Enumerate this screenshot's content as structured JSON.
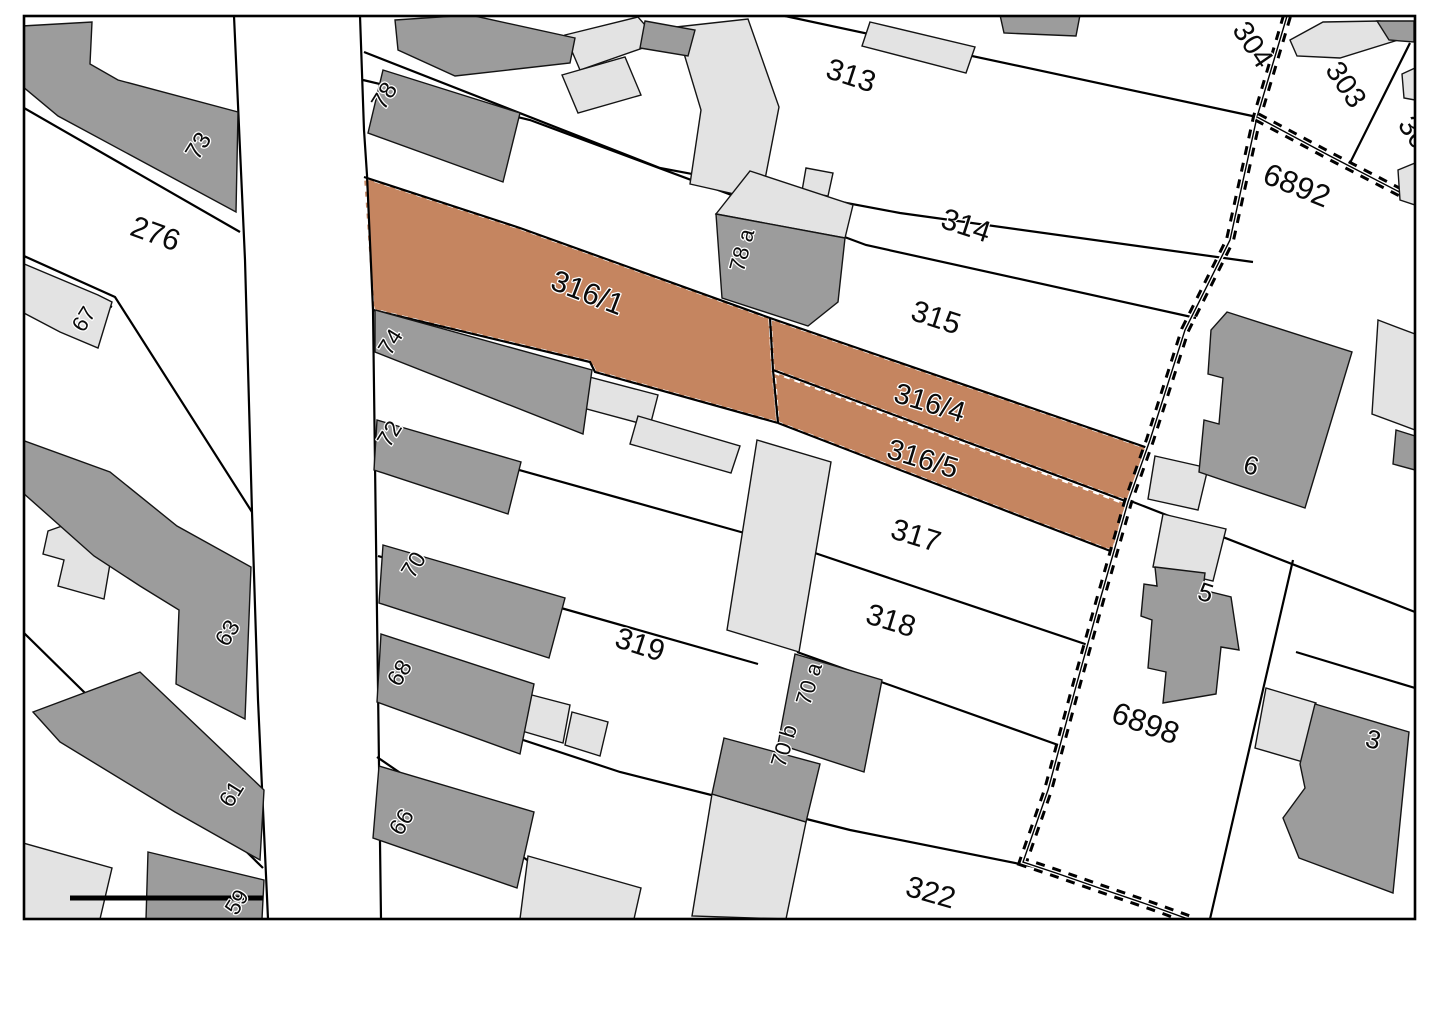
{
  "map": {
    "kind": "cadastral-parcel-map",
    "colors": {
      "highlight_parcel": "#c58560",
      "building_dark": "#9c9c9c",
      "building_light": "#e3e3e3",
      "line": "#000000",
      "background": "#ffffff"
    },
    "highlighted_parcels": [
      "316/1",
      "316/4",
      "316/5"
    ],
    "labels": [
      {
        "text": "73",
        "x": 205,
        "y": 150,
        "rot": -58,
        "size": 24,
        "kind": "building"
      },
      {
        "text": "78",
        "x": 391,
        "y": 100,
        "rot": -58,
        "size": 24,
        "kind": "building"
      },
      {
        "text": "276",
        "x": 152,
        "y": 243,
        "rot": 20,
        "size": 30,
        "kind": "parcel"
      },
      {
        "text": "67",
        "x": 90,
        "y": 323,
        "rot": -58,
        "size": 22,
        "kind": "building"
      },
      {
        "text": "313",
        "x": 848,
        "y": 85,
        "rot": 18,
        "size": 30,
        "kind": "parcel"
      },
      {
        "text": "314",
        "x": 963,
        "y": 235,
        "rot": 18,
        "size": 30,
        "kind": "parcel"
      },
      {
        "text": "315",
        "x": 933,
        "y": 327,
        "rot": 18,
        "size": 30,
        "kind": "parcel"
      },
      {
        "text": "78 a",
        "x": 749,
        "y": 252,
        "rot": -75,
        "size": 22,
        "kind": "building"
      },
      {
        "text": "316/1",
        "x": 584,
        "y": 302,
        "rot": 21,
        "size": 30,
        "kind": "parcel-highlight"
      },
      {
        "text": "74",
        "x": 397,
        "y": 346,
        "rot": -58,
        "size": 23,
        "kind": "building"
      },
      {
        "text": "72",
        "x": 396,
        "y": 438,
        "rot": -58,
        "size": 23,
        "kind": "building"
      },
      {
        "text": "316/4",
        "x": 927,
        "y": 412,
        "rot": 17,
        "size": 29,
        "kind": "parcel-highlight"
      },
      {
        "text": "316/5",
        "x": 920,
        "y": 468,
        "rot": 17,
        "size": 29,
        "kind": "parcel-highlight"
      },
      {
        "text": "317",
        "x": 913,
        "y": 545,
        "rot": 17,
        "size": 30,
        "kind": "parcel"
      },
      {
        "text": "318",
        "x": 888,
        "y": 630,
        "rot": 17,
        "size": 30,
        "kind": "parcel"
      },
      {
        "text": "319",
        "x": 637,
        "y": 654,
        "rot": 18,
        "size": 30,
        "kind": "parcel"
      },
      {
        "text": "322",
        "x": 928,
        "y": 902,
        "rot": 16,
        "size": 30,
        "kind": "parcel"
      },
      {
        "text": "70",
        "x": 420,
        "y": 569,
        "rot": -58,
        "size": 23,
        "kind": "building"
      },
      {
        "text": "68",
        "x": 406,
        "y": 677,
        "rot": -58,
        "size": 23,
        "kind": "building"
      },
      {
        "text": "66",
        "x": 408,
        "y": 826,
        "rot": -58,
        "size": 23,
        "kind": "building"
      },
      {
        "text": "63",
        "x": 234,
        "y": 637,
        "rot": -58,
        "size": 23,
        "kind": "building"
      },
      {
        "text": "61",
        "x": 238,
        "y": 798,
        "rot": -58,
        "size": 23,
        "kind": "building"
      },
      {
        "text": "59",
        "x": 243,
        "y": 906,
        "rot": -58,
        "size": 22,
        "kind": "building"
      },
      {
        "text": "70 a",
        "x": 816,
        "y": 686,
        "rot": -73,
        "size": 22,
        "kind": "building"
      },
      {
        "text": "70 b",
        "x": 791,
        "y": 748,
        "rot": -73,
        "size": 22,
        "kind": "building"
      },
      {
        "text": "6892",
        "x": 1293,
        "y": 195,
        "rot": 22,
        "size": 31,
        "kind": "parcel"
      },
      {
        "text": "6898",
        "x": 1142,
        "y": 733,
        "rot": 20,
        "size": 31,
        "kind": "parcel"
      },
      {
        "text": "304",
        "x": 1245,
        "y": 50,
        "rot": 56,
        "size": 29,
        "kind": "parcel"
      },
      {
        "text": "303",
        "x": 1338,
        "y": 90,
        "rot": 56,
        "size": 29,
        "kind": "parcel"
      },
      {
        "text": "30",
        "x": 1406,
        "y": 138,
        "rot": 56,
        "size": 29,
        "kind": "parcel"
      },
      {
        "text": "6",
        "x": 1249,
        "y": 474,
        "rot": 15,
        "size": 26,
        "kind": "building"
      },
      {
        "text": "5",
        "x": 1203,
        "y": 601,
        "rot": 18,
        "size": 26,
        "kind": "building"
      },
      {
        "text": "3",
        "x": 1371,
        "y": 748,
        "rot": 15,
        "size": 26,
        "kind": "building"
      }
    ]
  }
}
